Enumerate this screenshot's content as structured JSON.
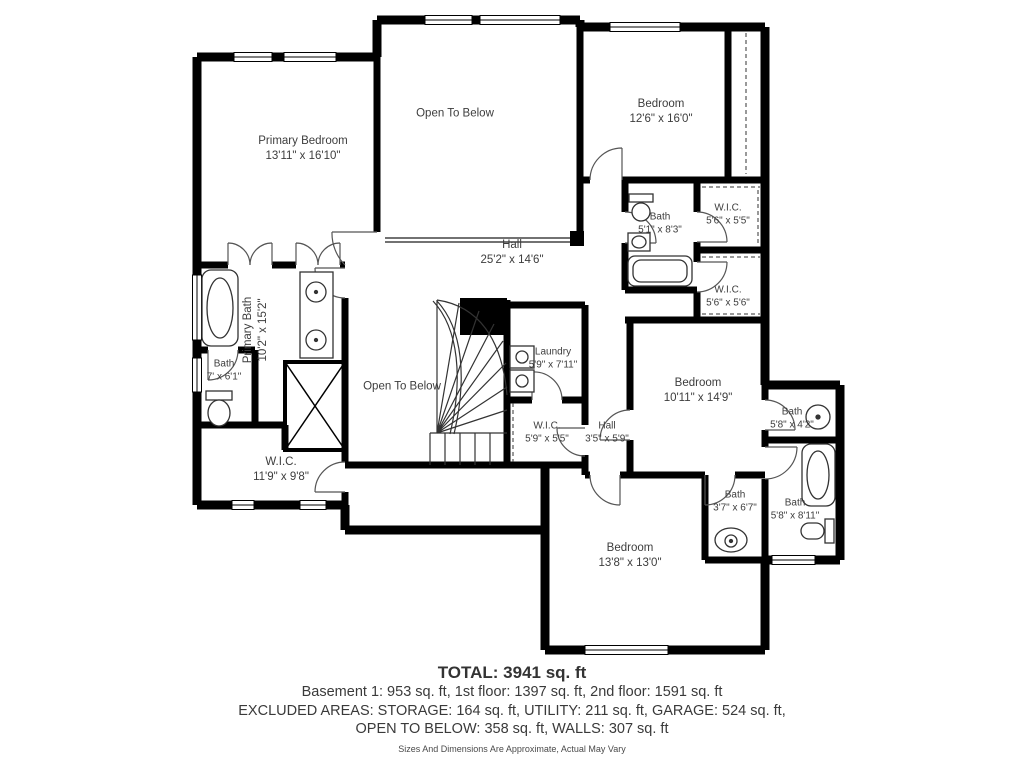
{
  "plan": {
    "colors": {
      "wall": "#000000",
      "text": "#3d3d3d"
    },
    "rooms": [
      {
        "name": "Primary Bedroom",
        "dims": "13'11\" x 16'10\""
      },
      {
        "name": "Open To Below",
        "dims": ""
      },
      {
        "name": "Bedroom",
        "dims": "12'6\" x 16'0\""
      },
      {
        "name": "Bath",
        "dims": "5'1\" x 8'3\""
      },
      {
        "name": "W.I.C.",
        "dims": "5'6\" x 5'5\""
      },
      {
        "name": "Hall",
        "dims": "25'2\" x 14'6\""
      },
      {
        "name": "W.I.C.",
        "dims": "5'6\" x 5'6\""
      },
      {
        "name": "Primary Bath",
        "dims": "10'2\" x 15'2\""
      },
      {
        "name": "Bath",
        "dims": "7' x 6'1\""
      },
      {
        "name": "Laundry",
        "dims": "5'9\" x 7'11\""
      },
      {
        "name": "Open To Below",
        "dims": ""
      },
      {
        "name": "W.I.C.",
        "dims": "5'9\" x 5'5\""
      },
      {
        "name": "Hall",
        "dims": "3'5\" x 5'9\""
      },
      {
        "name": "Bedroom",
        "dims": "10'11\" x 14'9\""
      },
      {
        "name": "Bath",
        "dims": "5'8\" x 4'2\""
      },
      {
        "name": "W.I.C.",
        "dims": "11'9\" x 9'8\""
      },
      {
        "name": "Bath",
        "dims": "3'7\" x 6'7\""
      },
      {
        "name": "Bath",
        "dims": "5'8\" x 8'11\""
      },
      {
        "name": "Bedroom",
        "dims": "13'8\" x 13'0\""
      }
    ],
    "summary": {
      "total": "TOTAL: 3941 sq. ft",
      "floors": "Basement 1: 953 sq. ft, 1st floor: 1397 sq. ft, 2nd floor: 1591 sq. ft",
      "excluded1": "EXCLUDED AREAS: STORAGE: 164 sq. ft, UTILITY: 211 sq. ft, GARAGE: 524 sq. ft,",
      "excluded2": "OPEN TO BELOW: 358 sq. ft, WALLS: 307 sq. ft",
      "disclaimer": "Sizes And Dimensions Are Approximate, Actual May Vary"
    }
  }
}
